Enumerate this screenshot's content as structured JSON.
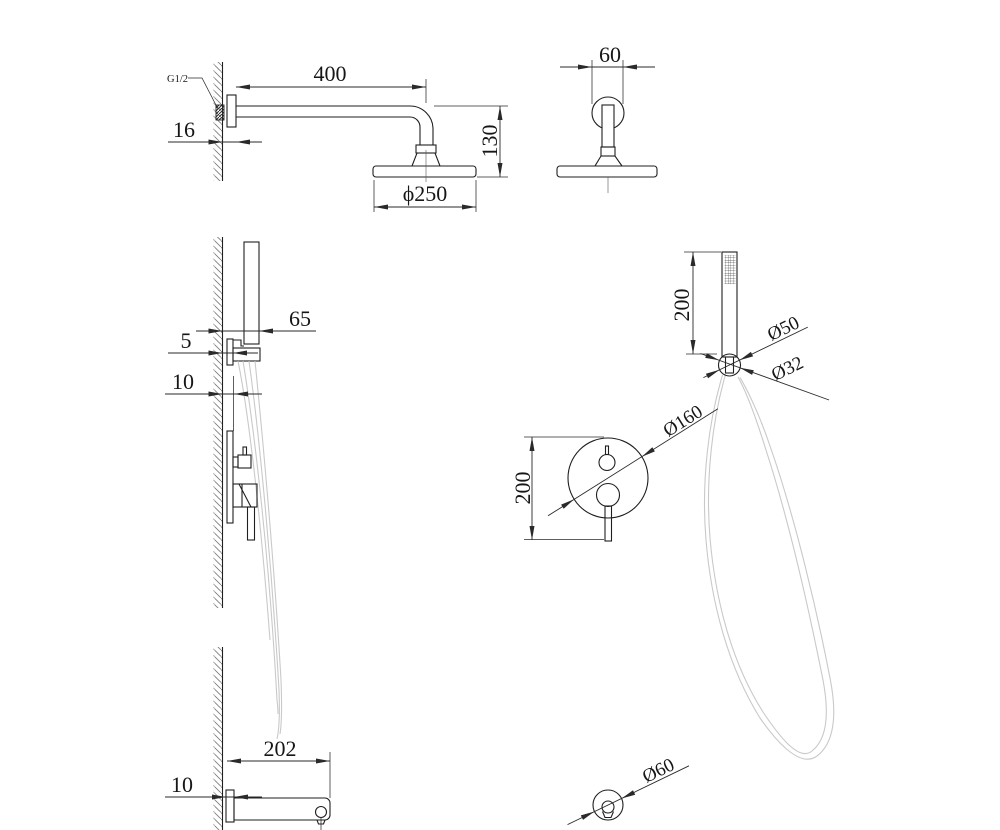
{
  "drawing": {
    "type": "technical-dimension-drawing",
    "subject": "concealed shower set with overhead shower, hand shower and bath spout",
    "colors": {
      "line": "#1f1f1f",
      "hose": "#c9c9c9",
      "hatch": "#787878",
      "background": "#ffffff"
    },
    "labels": {
      "overhead_side": {
        "thread_size": "G1/2",
        "arm_length": "400",
        "wall_plate_depth": "16",
        "drop_height": "130",
        "head_diameter": "ϕ250"
      },
      "overhead_front": {
        "escutcheon_width": "60"
      },
      "handshower_holder_side": {
        "holder_offset": "65",
        "holder_plate_depth": "5",
        "valve_plate_depth": "10"
      },
      "handshower_front": {
        "handle_length": "200",
        "holder_diameter": "Ø50",
        "connector_diameter": "Ø32"
      },
      "mixer_valve_front": {
        "valve_height": "200",
        "plate_diameter": "Ø160"
      },
      "spout_side": {
        "spout_length": "202",
        "spout_plate_depth": "10"
      },
      "spout_end": {
        "spout_diameter": "Ø60"
      }
    }
  }
}
